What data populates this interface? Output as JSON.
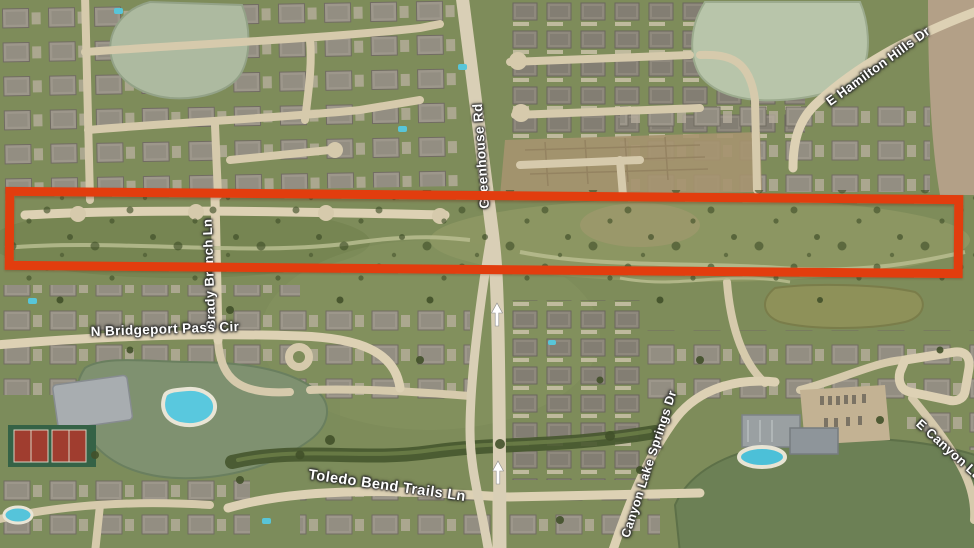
{
  "map": {
    "view": "satellite-aerial",
    "labels": {
      "greenhouse_rd": "Greenhouse Rd",
      "e_hamilton_hills_dr": "E Hamilton Hills Dr",
      "brady_branch_ln": "Brady Branch Ln",
      "n_bridgeport_pass_cir": "N Bridgeport Pass Cir",
      "toledo_bend_trails_ln": "Toledo Bend Trails Ln",
      "canyon_lake_springs_dr": "Canyon Lake Springs Dr",
      "e_canyon_partial": "E Canyon Lak"
    },
    "annotation": {
      "shape": "rectangle",
      "stroke_color": "#e23d0e"
    },
    "icons": {
      "one_way_arrow": "white north-pointing one-way arrow on Greenhouse Rd (x2)"
    },
    "colors": {
      "label_text": "#ffffff",
      "annotation_red": "#e23d0e"
    }
  }
}
